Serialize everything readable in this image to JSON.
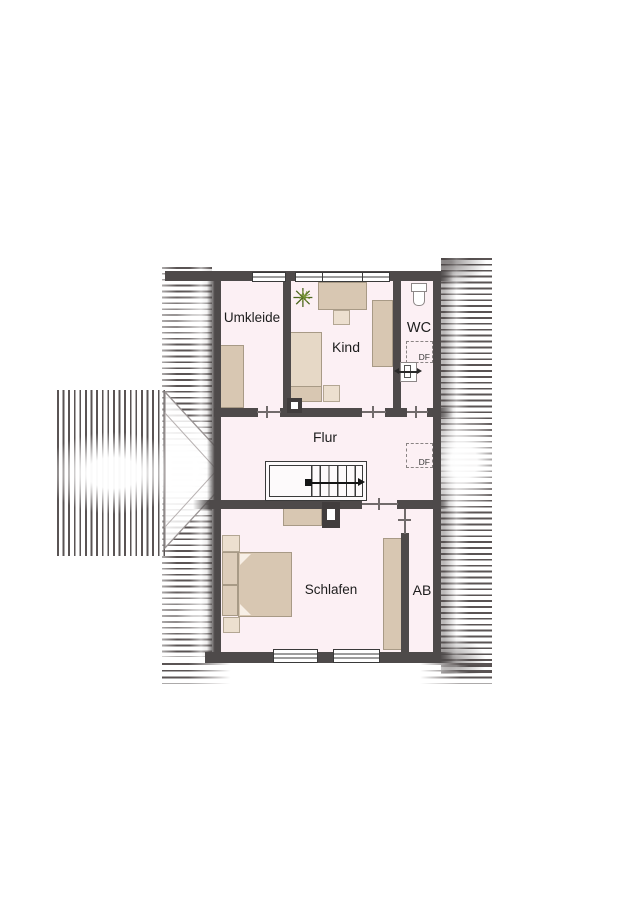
{
  "rooms": {
    "umkleide": "Umkleide",
    "kind": "Kind",
    "wc": "WC",
    "flur": "Flur",
    "schlafen": "Schlafen",
    "ab": "AB"
  },
  "skylights": {
    "wc_label": "DF",
    "flur_label": "DF"
  },
  "icons": {
    "plant": "✳"
  },
  "colors": {
    "wall": "#4e4a4a",
    "floor": "#fcf0f4",
    "furniture": "#d8c7b2",
    "furniture_light": "#ecdfcf",
    "furniture_border": "#a89a86",
    "roof_hatch": "#5a5454",
    "plant_green": "#4c661e",
    "skylight_dash": "#8a8484"
  }
}
